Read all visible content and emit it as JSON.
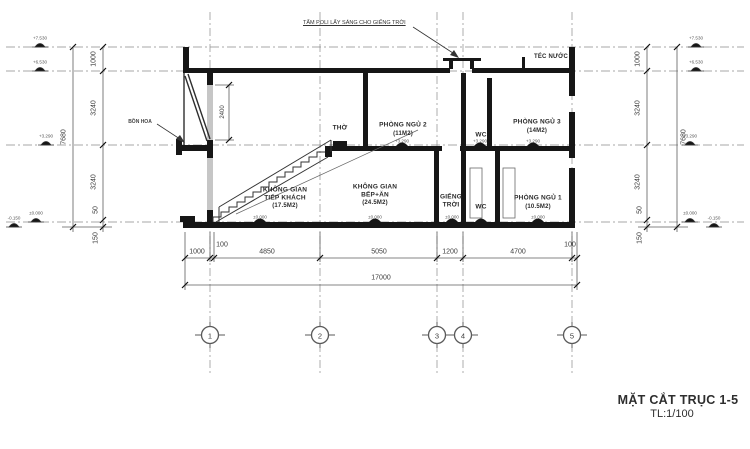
{
  "drawing": {
    "title": "MẶT CẮT TRỤC 1-5",
    "scale": "TL:1/100",
    "annotation": "TẤM POLI LẤY SÁNG CHO GIẾNG TRỜI",
    "labels": {
      "tec_nuoc": "TÉC NƯỚC",
      "bon_hoa": "BỒN HOA",
      "tho": "THỜ"
    },
    "rooms": {
      "pn2": {
        "name": "PHÒNG NGỦ 2",
        "area": "(11M2)"
      },
      "wc2": "WC",
      "pn3": {
        "name": "PHÒNG NGỦ 3",
        "area": "(14M2)"
      },
      "tiep_khach": {
        "l1": "KHÔNG GIAN",
        "l2": "TIẾP KHÁCH",
        "area": "(17.5M2)"
      },
      "bep_an": {
        "l1": "KHÔNG GIAN",
        "l2": "BẾP+ĂN",
        "area": "(24.5M2)"
      },
      "gieng_troi": {
        "l1": "GIẾNG",
        "l2": "TRỜI"
      },
      "wc1": "WC",
      "pn1": {
        "name": "PHÒNG NGỦ 1",
        "area": "(10.5M2)"
      }
    },
    "dims": {
      "left": [
        "1000",
        "3240",
        "3240",
        "50",
        "150"
      ],
      "right": [
        "1000",
        "3240",
        "3240",
        "50",
        "150"
      ],
      "total_height": "7680",
      "bottom": [
        "1000",
        "100",
        "4850",
        "5050",
        "1200",
        "4700",
        "100"
      ],
      "total_width": "17000",
      "window": "2400"
    },
    "levels": {
      "top": "+7.530",
      "roof": "+6.530",
      "floor2": "+3.290",
      "ground": "±0.000",
      "outside": "-0.150"
    },
    "grids": [
      "1",
      "2",
      "3",
      "4",
      "5"
    ]
  }
}
